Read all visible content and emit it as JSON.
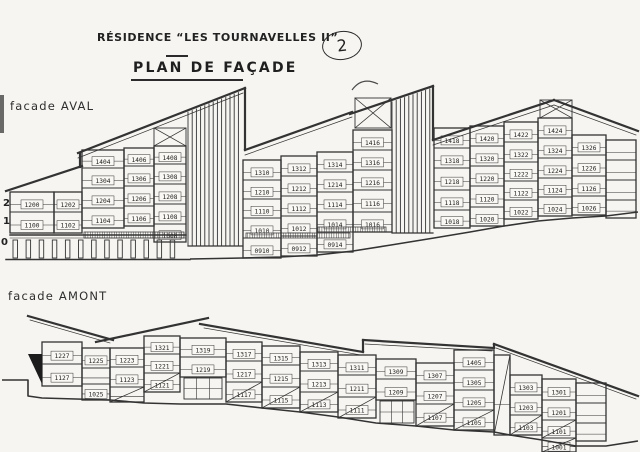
{
  "header": {
    "title": "RÉSIDENCE “LES TOURNAVELLES II”",
    "subtitle": "PLAN DE FAÇADE",
    "page_number": "2"
  },
  "facades": [
    {
      "id": "aval",
      "label": "facade AVAL",
      "floor_labels": [
        "2",
        "1",
        "0"
      ],
      "columns": [
        {
          "units": [
            "1200",
            "1100"
          ]
        },
        {
          "units": [
            "1202",
            "1102"
          ]
        },
        {
          "units": [
            "1404",
            "1304",
            "1204",
            "1104"
          ]
        },
        {
          "units": [
            "1406",
            "1306",
            "1206",
            "1106"
          ]
        },
        {
          "units": [
            "1408",
            "1308",
            "1208",
            "1108",
            "1008"
          ]
        },
        {
          "units": [
            "1310",
            "1210",
            "1110",
            "1010",
            "0910"
          ]
        },
        {
          "units": [
            "1312",
            "1212",
            "1112",
            "1012",
            "0912"
          ]
        },
        {
          "units": [
            "1314",
            "1214",
            "1114",
            "1014",
            "0914"
          ]
        },
        {
          "units": [
            "1416",
            "1316",
            "1216",
            "1116",
            "1016"
          ]
        },
        {
          "units": [
            "1418",
            "1318",
            "1218",
            "1118",
            "1018"
          ]
        },
        {
          "units": [
            "1420",
            "1320",
            "1220",
            "1120",
            "1020"
          ]
        },
        {
          "units": [
            "1422",
            "1322",
            "1222",
            "1122",
            "1022"
          ]
        },
        {
          "units": [
            "1424",
            "1324",
            "1224",
            "1124",
            "1024"
          ]
        },
        {
          "units": [
            "1326",
            "1226",
            "1126",
            "1026"
          ]
        },
        {
          "units": [
            "",
            "",
            "",
            ""
          ]
        }
      ]
    },
    {
      "id": "amont",
      "label": "facade AMONT",
      "floor_labels": [],
      "columns": [
        {
          "units": [
            "1227",
            "1127"
          ]
        },
        {
          "units": [
            "1225",
            "",
            "1025"
          ]
        },
        {
          "units": [
            "1223",
            "1123",
            ""
          ]
        },
        {
          "units": [
            "1321",
            "1221",
            "1121"
          ]
        },
        {
          "units": [
            "1319",
            "1219"
          ]
        },
        {
          "units": [
            "1317",
            "1217",
            "1117"
          ]
        },
        {
          "units": [
            "1315",
            "1215",
            "1115"
          ]
        },
        {
          "units": [
            "1313",
            "1213",
            "1113"
          ]
        },
        {
          "units": [
            "1311",
            "1211",
            "1111"
          ]
        },
        {
          "units": [
            "1309",
            "1209"
          ]
        },
        {
          "units": [
            "1307",
            "1207",
            "1107"
          ]
        },
        {
          "units": [
            "1405",
            "1305",
            "1205",
            "1105"
          ]
        },
        {
          "units": [
            ""
          ]
        },
        {
          "units": [
            "1303",
            "1203",
            "1103"
          ]
        },
        {
          "units": [
            "1301",
            "1201",
            "1101",
            "1001"
          ]
        },
        {
          "units": [
            "",
            "",
            ""
          ]
        }
      ]
    }
  ]
}
